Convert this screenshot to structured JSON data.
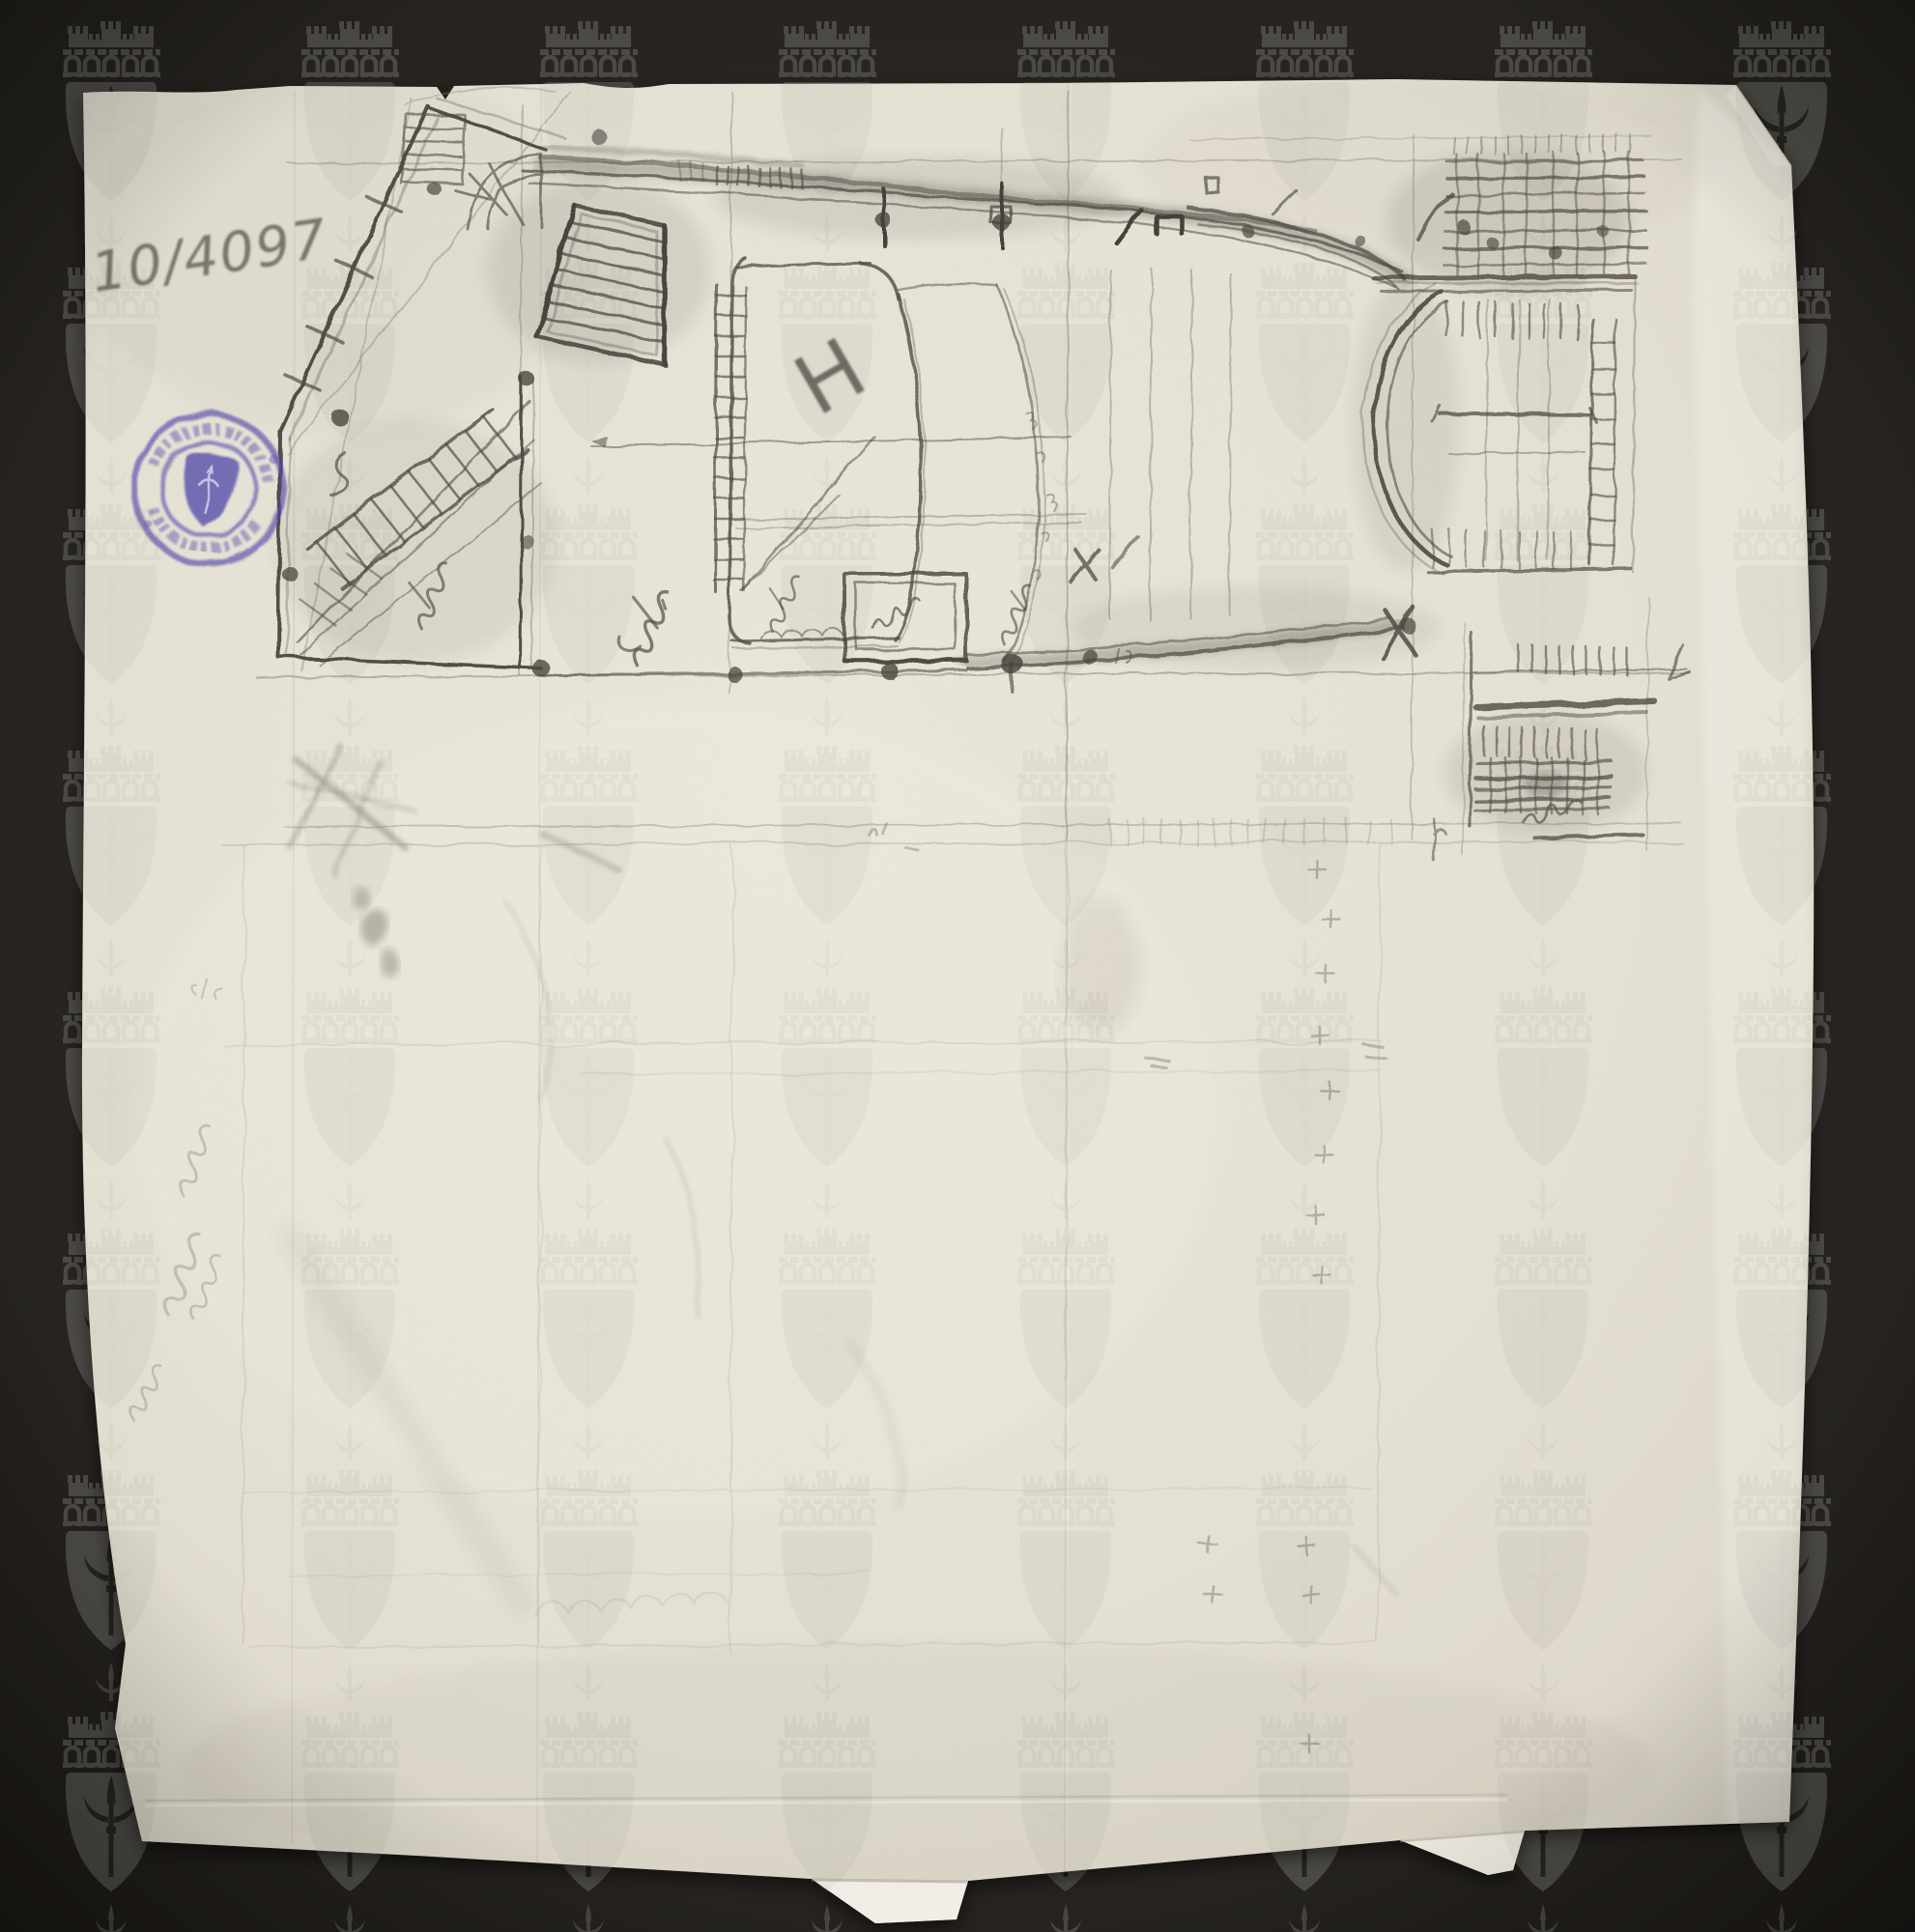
{
  "scan": {
    "inventory_number": "10/4097",
    "hall_label": "H",
    "stamp": {
      "shape": "double-ring circular ink stamp",
      "center_motif": "shield-icon",
      "ring_text_legible": false
    },
    "watermark_motif": "mural-crown-castle-over-halberd-shield",
    "colors": {
      "background": "#272420",
      "watermark_gray": "#4d4b45",
      "paper": "#e6e2d5",
      "pencil": "#524e47",
      "stamp_ink": "#5145ab"
    }
  }
}
